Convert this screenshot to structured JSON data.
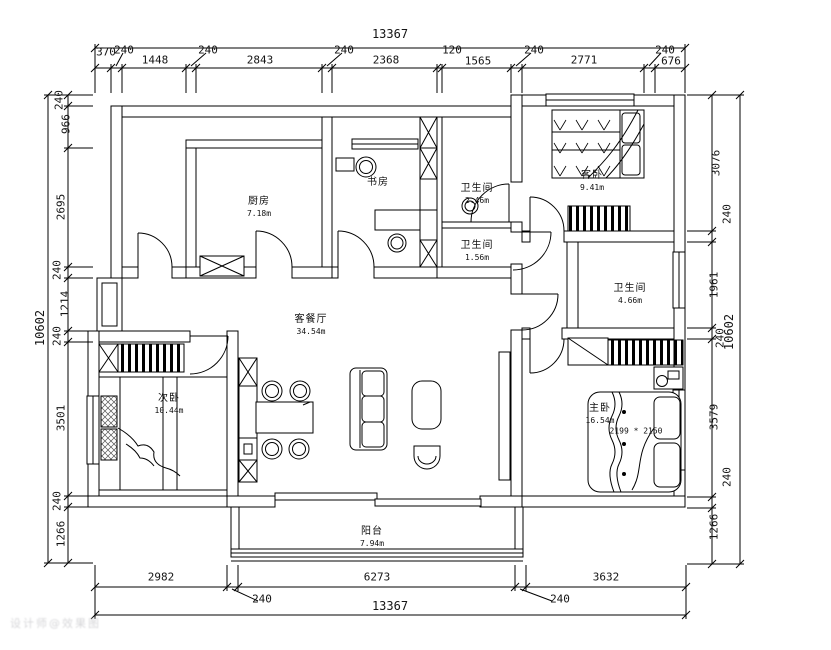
{
  "plan": {
    "dimensions": {
      "top": {
        "total": "13367",
        "segments": [
          "370",
          "240",
          "1448",
          "240",
          "2843",
          "240",
          "2368",
          "120",
          "1565",
          "240",
          "2771",
          "240",
          "676"
        ]
      },
      "bottom": {
        "total": "13367",
        "segments": [
          "2982",
          "240",
          "6273",
          "240",
          "3632"
        ]
      },
      "left": {
        "total": "10602",
        "segments": [
          "240",
          "966",
          "2695",
          "240",
          "1214",
          "240",
          "3501",
          "240",
          "1266"
        ]
      },
      "right": {
        "total": "10602",
        "segments": [
          "3076",
          "240",
          "1961",
          "240",
          "3579",
          "240",
          "1266"
        ]
      }
    },
    "rooms": {
      "kitchen": {
        "name": "厨房",
        "area": "7.18m"
      },
      "study": {
        "name": "书房",
        "area": ""
      },
      "bath_top": {
        "name": "卫生间",
        "area": "2.46m"
      },
      "bath_mid": {
        "name": "卫生间",
        "area": "1.56m"
      },
      "guest_bedroom": {
        "name": "客卧",
        "area": "9.41m"
      },
      "bath_master": {
        "name": "卫生间",
        "area": "4.66m"
      },
      "living_dining": {
        "name": "客餐厅",
        "area": "34.54m"
      },
      "second_bedroom": {
        "name": "次卧",
        "area": "10.44m"
      },
      "master_bedroom": {
        "name": "主卧",
        "area": "16.54m",
        "bed_size": "2199 * 2150"
      },
      "balcony": {
        "name": "阳台",
        "area": "7.94m"
      }
    },
    "watermark": "设计师@效果图"
  }
}
